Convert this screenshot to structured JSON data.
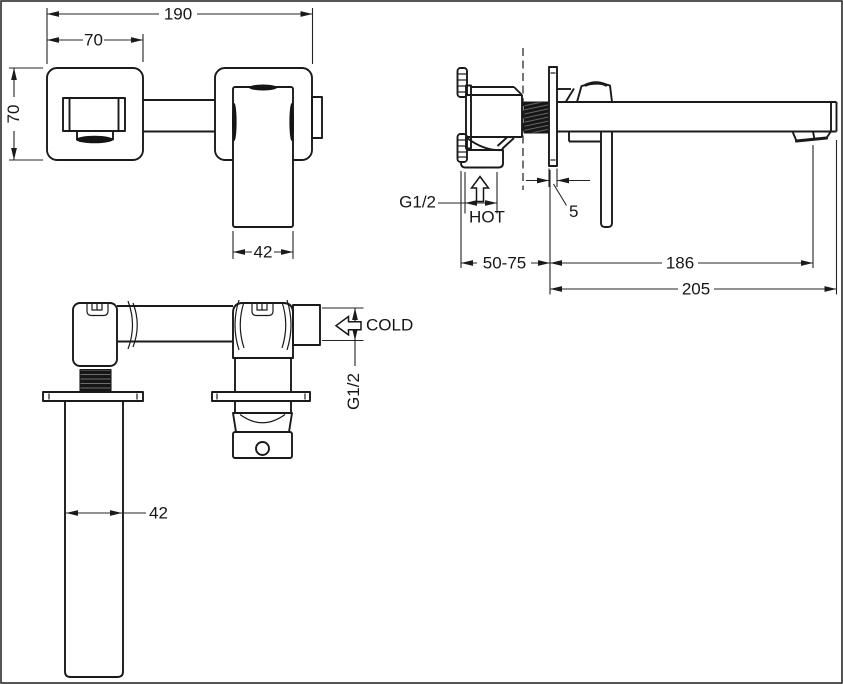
{
  "title": "Wall-mounted basin mixer installation drawing",
  "colors": {
    "background": "#ffffff",
    "line": "#1a1a1a",
    "text": "#161616"
  },
  "front_view": {
    "dim_overall_width": "190",
    "dim_plate_width": "70",
    "dim_plate_height": "70",
    "dim_handle_width": "42"
  },
  "side_view": {
    "dim_inlet_thread": "G1/2",
    "label_hot": "HOT",
    "dim_plate_thickness": "5",
    "dim_wall_distance": "50-75",
    "dim_spout_reach": "186",
    "dim_overall_depth": "205"
  },
  "bottom_view": {
    "dim_spout_width": "42",
    "label_cold": "COLD",
    "dim_inlet_thread": "G1/2"
  }
}
